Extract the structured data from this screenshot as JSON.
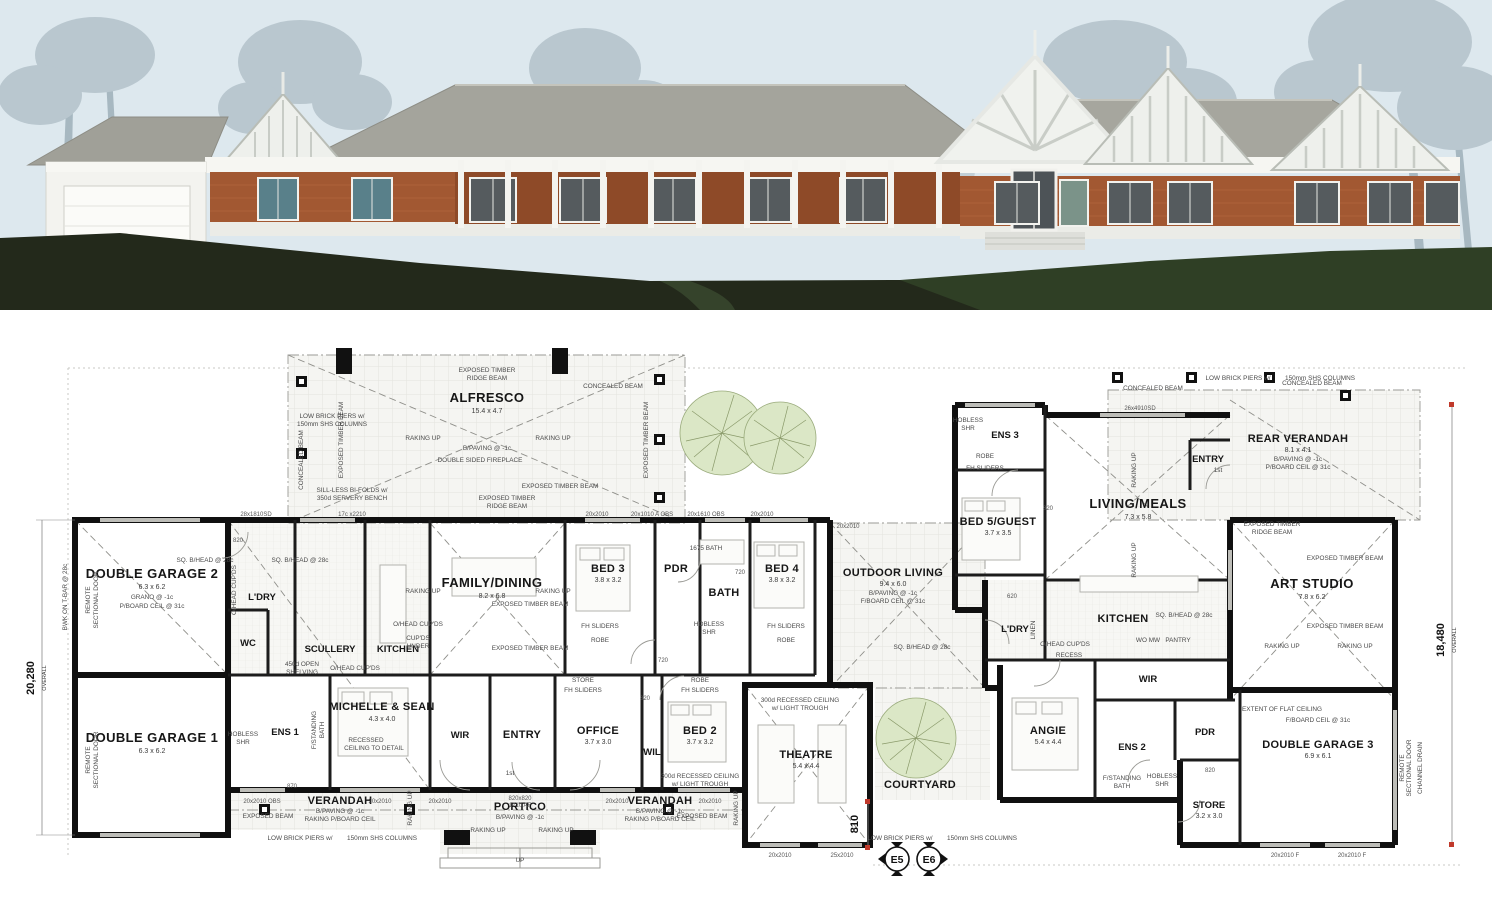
{
  "scene": {
    "sky": "#dde8ee",
    "tree": "#b9c7cf",
    "tree_dark": "#a7b8c1",
    "ground_dark": "#23291b",
    "ground_green": "#2f3f25",
    "brick": "#a25832",
    "brick_shadow": "#8e4a28",
    "roof": "#a4a49c",
    "roof_dark": "#97978f",
    "wall_white": "#f3f3ef",
    "window": "#555b5e"
  },
  "plan": {
    "dims": {
      "left": "20,280",
      "right": "18,480",
      "overall": "OVERALL",
      "d810": "810"
    },
    "markers": {
      "e5": "E5",
      "e6": "E6"
    },
    "rooms": {
      "alfresco": {
        "name": "ALFRESCO",
        "dim": "15.4 x 4.7"
      },
      "family_dining": {
        "name": "FAMILY/DINING",
        "dim": "8.2 x 6.8"
      },
      "garage2": {
        "name": "DOUBLE GARAGE 2",
        "dim": "6.3 x 6.2",
        "note1": "GRANO @ -1c",
        "note2": "P/BOARD CEIL @ 31c"
      },
      "garage1": {
        "name": "DOUBLE GARAGE 1",
        "dim": "6.3 x 6.2",
        "note1": "GRANO @ -1c",
        "note2": "P/BOARD CEIL @ 31c"
      },
      "ldry": {
        "name": "L'DRY"
      },
      "scullery": {
        "name": "SCULLERY"
      },
      "kitchen": {
        "name": "KITCHEN"
      },
      "wc": {
        "name": "WC"
      },
      "ens1": {
        "name": "ENS 1"
      },
      "master": {
        "name": "MICHELLE & SEAN",
        "dim": "4.3 x 4.0",
        "note1": "RECESSED",
        "note2": "CEILING TO DETAIL"
      },
      "wir": {
        "name": "WIR"
      },
      "entry": {
        "name": "ENTRY"
      },
      "office": {
        "name": "OFFICE",
        "dim": "3.7 x 3.0"
      },
      "wil": {
        "name": "WIL"
      },
      "bed2": {
        "name": "BED 2",
        "dim": "3.7 x 3.2"
      },
      "bed3": {
        "name": "BED 3",
        "dim": "3.8 x 3.2"
      },
      "pdr": {
        "name": "PDR"
      },
      "bath": {
        "name": "BATH"
      },
      "bed4": {
        "name": "BED 4",
        "dim": "3.8 x 3.2"
      },
      "theatre": {
        "name": "THEATRE",
        "dim": "5.4 x 4.4"
      },
      "verandah": {
        "name": "VERANDAH",
        "note1": "B/PAVING @ -1c",
        "note2": "RAKING P/BOARD CEIL"
      },
      "portico": {
        "name": "PORTICO",
        "note1": "B/PAVING @ -1c"
      },
      "outdoor_living": {
        "name": "OUTDOOR LIVING",
        "dim": "9.4 x 6.0",
        "note1": "B/PAVING @ -1c",
        "note2": "F/BOARD CEIL @ 31c"
      },
      "courtyard": {
        "name": "COURTYARD"
      },
      "ens3": {
        "name": "ENS 3"
      },
      "bed5": {
        "name": "BED 5/GUEST",
        "dim": "3.7 x 3.5"
      },
      "living_meals": {
        "name": "LIVING/MEALS",
        "dim": "7.3 x 5.8"
      },
      "entry2": {
        "name": "ENTRY"
      },
      "rear_verandah": {
        "name": "REAR VERANDAH",
        "dim": "8.1 x 4.1",
        "note1": "B/PAVING @ -1c",
        "note2": "P/BOARD CEIL @ 31c"
      },
      "kitchen2": {
        "name": "KITCHEN"
      },
      "ldry2": {
        "name": "L'DRY"
      },
      "angie": {
        "name": "ANGIE",
        "dim": "5.4 x 4.4"
      },
      "wir2": {
        "name": "WIR"
      },
      "ens2": {
        "name": "ENS 2"
      },
      "pdr2": {
        "name": "PDR"
      },
      "store": {
        "name": "STORE",
        "dim": "3.2 x 3.0"
      },
      "art_studio": {
        "name": "ART STUDIO",
        "dim": "7.8 x 6.2"
      },
      "garage3": {
        "name": "DOUBLE GARAGE 3",
        "dim": "6.9 x 6.1",
        "note1": "F/BOARD CEIL @ 31c"
      }
    },
    "ann": {
      "etrb1": "EXPOSED TIMBER",
      "etrb2": "RIDGE BEAM",
      "etb": "EXPOSED TIMBER BEAM",
      "eb": "EXPOSED BEAM",
      "cb": "CONCEALED BEAM",
      "raking": "RAKING UP",
      "bpaving": "B/PAVING @ -1c",
      "lbp1": "LOW BRICK PIERS w/",
      "lbp2": "150mm SHS COLUMNS",
      "sill1": "SILL-LESS BI-FOLDS w/",
      "sill2": "350d SERVERY BENCH",
      "fire": "DOUBLE SIDED FIREPLACE",
      "sqb": "SQ. B/HEAD @ 28c",
      "rc1": "300d RECESSED CEILING",
      "rc2": "w/ LIGHT TROUGH",
      "flat": "EXTENT OF FLAT CEILING",
      "remote1": "REMOTE",
      "remote2": "SECTIONAL DOOR",
      "bwk": "BWK ON T-BAR @ 28c",
      "chan": "CHANNEL DRAIN",
      "fh": "FH SLIDERS",
      "robe": "ROBE",
      "store": "STORE",
      "linen": "LINEN",
      "pantry": "PANTRY",
      "womw": "WO MW",
      "hob1": "HOBLESS",
      "hob2": "SHR",
      "fsb1": "F/STANDING",
      "fsb2": "BATH",
      "ohc": "O/HEAD CUP'DS",
      "cu1": "CUP'DS",
      "cu2": "UNDER",
      "shelv1": "450d OPEN",
      "shelv2": "SHELVING",
      "recess": "RECESS",
      "b1675": "1675 BATH",
      "up": "UP",
      "first": "1st",
      "rcd1": "RECESSED",
      "rcd2": "CEILING TO DETAIL"
    },
    "wdims": {
      "w1": "20x2010",
      "w2": "25x2010",
      "w3": "20x2010 OBS",
      "w4": "20x1010 A OBS",
      "w5": "20x1610 OBS",
      "w6": "26x4910SD",
      "w7": "28x1810SD",
      "w8": "17c x2210",
      "w9": "820x820",
      "w9b": "1710 AF",
      "w10": "20x2010 F",
      "d820": "820",
      "d870": "870",
      "d720": "720",
      "d620": "620"
    }
  }
}
